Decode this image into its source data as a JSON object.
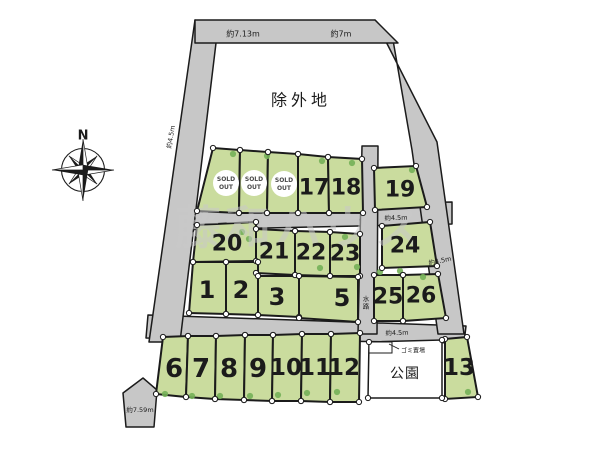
{
  "canvas": {
    "width": 600,
    "height": 450,
    "background": "#ffffff"
  },
  "colors": {
    "road": "#c7c7c7",
    "plot_green": "#cadc9e",
    "outline": "#1b1b1b",
    "tree": "#74b058",
    "dot_fill": "#ffffff",
    "text": "#1b1b1b",
    "sold_text": "#4a4a4a",
    "watermark": "#c9c9c9",
    "park_fill": "#ffffff"
  },
  "watermark": {
    "text": "藤和ハウス",
    "x": 300,
    "y": 228,
    "size": 46,
    "spacing": 4,
    "opacity": 0.55
  },
  "compass": {
    "label": "N",
    "cx": 83,
    "cy": 170,
    "ring_r": 21.5,
    "label_x": 83,
    "label_y": 136
  },
  "region_labels": [
    {
      "name": "excluded-area-label",
      "text": "除外地",
      "x": 301,
      "y": 100,
      "size": 16,
      "spacing": 4
    },
    {
      "name": "park-label",
      "text": "公園",
      "x": 405,
      "y": 374,
      "size": 14,
      "spacing": 1
    },
    {
      "name": "waterway-label",
      "text": "水路",
      "x": 366,
      "y": 299,
      "size": 6.5,
      "vertical": true
    },
    {
      "name": "garbage-label",
      "text": "ゴミ置場",
      "x": 413,
      "y": 351,
      "size": 6
    }
  ],
  "measurements": [
    {
      "text": "約7.13m",
      "x": 243,
      "y": 34,
      "size": 8,
      "rotate": 0
    },
    {
      "text": "約7m",
      "x": 341,
      "y": 34,
      "size": 8,
      "rotate": 0
    },
    {
      "text": "約4.5m",
      "x": 171,
      "y": 137,
      "size": 6.5,
      "rotate": -80
    },
    {
      "text": "約4.5m",
      "x": 396,
      "y": 218,
      "size": 6.5,
      "rotate": -2
    },
    {
      "text": "約4.5m",
      "x": 440,
      "y": 261,
      "size": 6.5,
      "rotate": -12
    },
    {
      "text": "約4.5m",
      "x": 397,
      "y": 333,
      "size": 6.5,
      "rotate": -2
    },
    {
      "text": "約7.59m",
      "x": 140,
      "y": 410,
      "size": 6.5,
      "rotate": 0
    }
  ],
  "roads": [
    {
      "name": "cross-road-upper",
      "points": [
        [
          176,
          208
        ],
        [
          452,
          202
        ],
        [
          452,
          224
        ],
        [
          172,
          230
        ]
      ]
    },
    {
      "name": "cross-road-lower",
      "points": [
        [
          148,
          315
        ],
        [
          466,
          326
        ],
        [
          464,
          343
        ],
        [
          146,
          338
        ]
      ]
    },
    {
      "name": "waterway-strip",
      "points": [
        [
          362,
          146
        ],
        [
          378,
          146
        ],
        [
          377,
          334
        ],
        [
          358,
          334
        ]
      ]
    },
    {
      "name": "left-road",
      "points": [
        [
          195,
          20
        ],
        [
          216,
          43
        ],
        [
          180,
          342
        ],
        [
          149,
          342
        ]
      ]
    },
    {
      "name": "right-road",
      "points": [
        [
          375,
          20
        ],
        [
          437,
          142
        ],
        [
          464,
          334
        ],
        [
          438,
          334
        ],
        [
          412,
          150
        ],
        [
          393,
          40
        ]
      ]
    },
    {
      "name": "top-road",
      "points": [
        [
          195,
          20
        ],
        [
          375,
          20
        ],
        [
          398,
          43
        ],
        [
          195,
          43
        ]
      ]
    },
    {
      "name": "road-end-arrow",
      "points": [
        [
          143,
          378
        ],
        [
          157,
          390
        ],
        [
          154,
          427
        ],
        [
          126,
          427
        ],
        [
          123,
          393
        ]
      ]
    }
  ],
  "park": {
    "points": [
      [
        369,
        342
      ],
      [
        442,
        340
      ],
      [
        442,
        398
      ],
      [
        368,
        398
      ]
    ],
    "garbage_box": [
      [
        369,
        342
      ],
      [
        392,
        342
      ],
      [
        392,
        353
      ],
      [
        369,
        353
      ]
    ],
    "leader": [
      [
        399,
        349
      ],
      [
        389,
        344
      ]
    ]
  },
  "sold_badge": {
    "lines": [
      "SOLD",
      "OUT"
    ],
    "radius": 13
  },
  "plots": [
    {
      "id": "sold-1",
      "sold": true,
      "points": [
        [
          213,
          148
        ],
        [
          240,
          150
        ],
        [
          239,
          213
        ],
        [
          197,
          211
        ]
      ],
      "lx": 226,
      "ly": 183,
      "fs": 22
    },
    {
      "id": "sold-2",
      "sold": true,
      "points": [
        [
          240,
          150
        ],
        [
          268,
          152
        ],
        [
          267,
          213
        ],
        [
          239,
          213
        ]
      ],
      "lx": 254,
      "ly": 183,
      "fs": 22
    },
    {
      "id": "sold-3",
      "sold": true,
      "points": [
        [
          268,
          152
        ],
        [
          298,
          154
        ],
        [
          298,
          213
        ],
        [
          267,
          213
        ]
      ],
      "lx": 284,
      "ly": 184,
      "fs": 22
    },
    {
      "id": "17",
      "num": "17",
      "points": [
        [
          298,
          154
        ],
        [
          328,
          157
        ],
        [
          329,
          213
        ],
        [
          298,
          213
        ]
      ],
      "lx": 314,
      "ly": 188,
      "fs": 22
    },
    {
      "id": "18",
      "num": "18",
      "points": [
        [
          328,
          157
        ],
        [
          362,
          159
        ],
        [
          363,
          213
        ],
        [
          329,
          213
        ]
      ],
      "lx": 346,
      "ly": 188,
      "fs": 22
    },
    {
      "id": "19",
      "num": "19",
      "points": [
        [
          374,
          168
        ],
        [
          416,
          166
        ],
        [
          427,
          207
        ],
        [
          375,
          210
        ]
      ],
      "lx": 400,
      "ly": 190,
      "fs": 22
    },
    {
      "id": "20",
      "num": "20",
      "points": [
        [
          197,
          225
        ],
        [
          256,
          222
        ],
        [
          256,
          261
        ],
        [
          193,
          262
        ]
      ],
      "lx": 227,
      "ly": 244,
      "fs": 22
    },
    {
      "id": "21",
      "num": "21",
      "points": [
        [
          256,
          229
        ],
        [
          295,
          231
        ],
        [
          295,
          275
        ],
        [
          256,
          273
        ]
      ],
      "lx": 274,
      "ly": 252,
      "fs": 22
    },
    {
      "id": "22",
      "num": "22",
      "points": [
        [
          295,
          231
        ],
        [
          330,
          232
        ],
        [
          330,
          276
        ],
        [
          295,
          275
        ]
      ],
      "lx": 311,
      "ly": 253,
      "fs": 22
    },
    {
      "id": "23",
      "num": "23",
      "points": [
        [
          330,
          232
        ],
        [
          360,
          234
        ],
        [
          360,
          276
        ],
        [
          330,
          276
        ]
      ],
      "lx": 345,
      "ly": 254,
      "fs": 22
    },
    {
      "id": "24",
      "num": "24",
      "points": [
        [
          382,
          226
        ],
        [
          430,
          222
        ],
        [
          437,
          266
        ],
        [
          382,
          268
        ]
      ],
      "lx": 405,
      "ly": 246,
      "fs": 22
    },
    {
      "id": "1",
      "num": "1",
      "points": [
        [
          193,
          262
        ],
        [
          226,
          262
        ],
        [
          226,
          314
        ],
        [
          189,
          313
        ]
      ],
      "lx": 207,
      "ly": 290,
      "fs": 24
    },
    {
      "id": "2",
      "num": "2",
      "points": [
        [
          226,
          262
        ],
        [
          258,
          262
        ],
        [
          258,
          315
        ],
        [
          226,
          314
        ]
      ],
      "lx": 241,
      "ly": 290,
      "fs": 24
    },
    {
      "id": "3",
      "num": "3",
      "points": [
        [
          258,
          276
        ],
        [
          299,
          276
        ],
        [
          299,
          317
        ],
        [
          258,
          315
        ]
      ],
      "lx": 277,
      "ly": 297,
      "fs": 24
    },
    {
      "id": "5",
      "num": "5",
      "points": [
        [
          299,
          276
        ],
        [
          358,
          277
        ],
        [
          358,
          322
        ],
        [
          299,
          318
        ]
      ],
      "lx": 342,
      "ly": 298,
      "fs": 24
    },
    {
      "id": "25",
      "num": "25",
      "points": [
        [
          374,
          275
        ],
        [
          403,
          275
        ],
        [
          403,
          321
        ],
        [
          374,
          321
        ]
      ],
      "lx": 388,
      "ly": 297,
      "fs": 22
    },
    {
      "id": "26",
      "num": "26",
      "points": [
        [
          403,
          275
        ],
        [
          438,
          274
        ],
        [
          446,
          318
        ],
        [
          403,
          321
        ]
      ],
      "lx": 421,
      "ly": 296,
      "fs": 22
    },
    {
      "id": "6",
      "num": "6",
      "points": [
        [
          163,
          337
        ],
        [
          188,
          336
        ],
        [
          186,
          397
        ],
        [
          156,
          394
        ]
      ],
      "lx": 174,
      "ly": 369,
      "fs": 26
    },
    {
      "id": "7",
      "num": "7",
      "points": [
        [
          188,
          336
        ],
        [
          216,
          336
        ],
        [
          215,
          399
        ],
        [
          186,
          397
        ]
      ],
      "lx": 201,
      "ly": 369,
      "fs": 26
    },
    {
      "id": "8",
      "num": "8",
      "points": [
        [
          216,
          336
        ],
        [
          245,
          335
        ],
        [
          244,
          400
        ],
        [
          215,
          399
        ]
      ],
      "lx": 229,
      "ly": 369,
      "fs": 26
    },
    {
      "id": "9",
      "num": "9",
      "points": [
        [
          245,
          335
        ],
        [
          273,
          335
        ],
        [
          272,
          401
        ],
        [
          244,
          400
        ]
      ],
      "lx": 258,
      "ly": 369,
      "fs": 26
    },
    {
      "id": "10",
      "num": "10",
      "points": [
        [
          273,
          335
        ],
        [
          302,
          334
        ],
        [
          301,
          401
        ],
        [
          272,
          401
        ]
      ],
      "lx": 286,
      "ly": 368,
      "fs": 23
    },
    {
      "id": "11",
      "num": "11",
      "points": [
        [
          302,
          334
        ],
        [
          331,
          334
        ],
        [
          330,
          402
        ],
        [
          301,
          401
        ]
      ],
      "lx": 315,
      "ly": 368,
      "fs": 23
    },
    {
      "id": "12",
      "num": "12",
      "points": [
        [
          331,
          334
        ],
        [
          360,
          333
        ],
        [
          359,
          402
        ],
        [
          330,
          402
        ]
      ],
      "lx": 344,
      "ly": 368,
      "fs": 23
    },
    {
      "id": "13",
      "num": "13",
      "points": [
        [
          445,
          339
        ],
        [
          467,
          337
        ],
        [
          478,
          397
        ],
        [
          445,
          399
        ]
      ],
      "lx": 459,
      "ly": 368,
      "fs": 23
    }
  ],
  "trees": [
    [
      233,
      154
    ],
    [
      267,
      156
    ],
    [
      322,
      161
    ],
    [
      352,
      163
    ],
    [
      412,
      170
    ],
    [
      242,
      232
    ],
    [
      249,
      239
    ],
    [
      345,
      237
    ],
    [
      320,
      268
    ],
    [
      357,
      267
    ],
    [
      380,
      272
    ],
    [
      400,
      271
    ],
    [
      423,
      277
    ],
    [
      165,
      394
    ],
    [
      192,
      396
    ],
    [
      220,
      396
    ],
    [
      250,
      396
    ],
    [
      278,
      395
    ],
    [
      307,
      393
    ],
    [
      337,
      392
    ],
    [
      468,
      392
    ]
  ]
}
